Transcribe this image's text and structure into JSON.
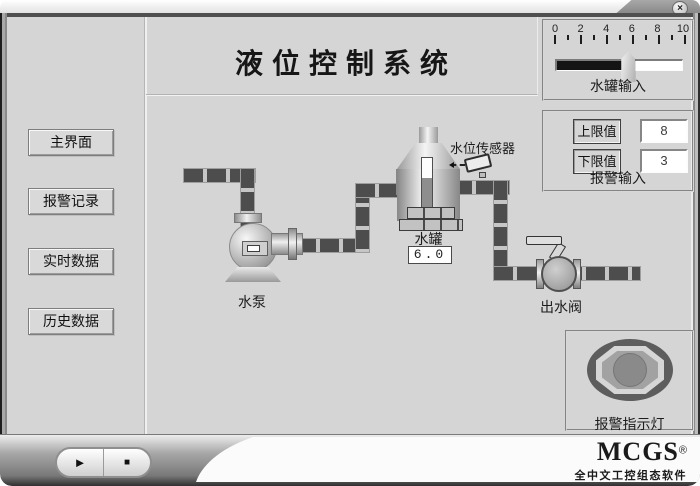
{
  "window": {
    "close_label": "×"
  },
  "header": {
    "title": "液位控制系统"
  },
  "sidebar": {
    "items": [
      {
        "label": "主界面"
      },
      {
        "label": "报警记录"
      },
      {
        "label": "实时数据"
      },
      {
        "label": "历史数据"
      }
    ]
  },
  "tank_input_panel": {
    "label": "水罐输入",
    "scale_labels": [
      "0",
      "2",
      "4",
      "6",
      "8",
      "10"
    ],
    "scale_min": 0,
    "scale_max": 10,
    "slider_value": 6.3,
    "fill_percent": 57
  },
  "alarm_panel": {
    "label": "报警输入",
    "rows": [
      {
        "label": "上限值",
        "value": "8"
      },
      {
        "label": "下限值",
        "value": "3"
      }
    ]
  },
  "diagram": {
    "pump": {
      "label": "水泵"
    },
    "tank": {
      "label": "水罐",
      "value": "6.0",
      "level_percent": 60
    },
    "sensor": {
      "label": "水位传感器"
    },
    "valve": {
      "label": "出水阀"
    }
  },
  "alarm_indicator": {
    "label": "报警指示灯"
  },
  "runtime_bar": {
    "play": "►",
    "stop": "■"
  },
  "brand": {
    "name": "MCGS",
    "reg": "®",
    "subtitle": "全中文工控组态软件"
  },
  "colors": {
    "pipe": "#4d4d4d",
    "background": "#d5d5d5",
    "slider_fill": "#141414"
  }
}
